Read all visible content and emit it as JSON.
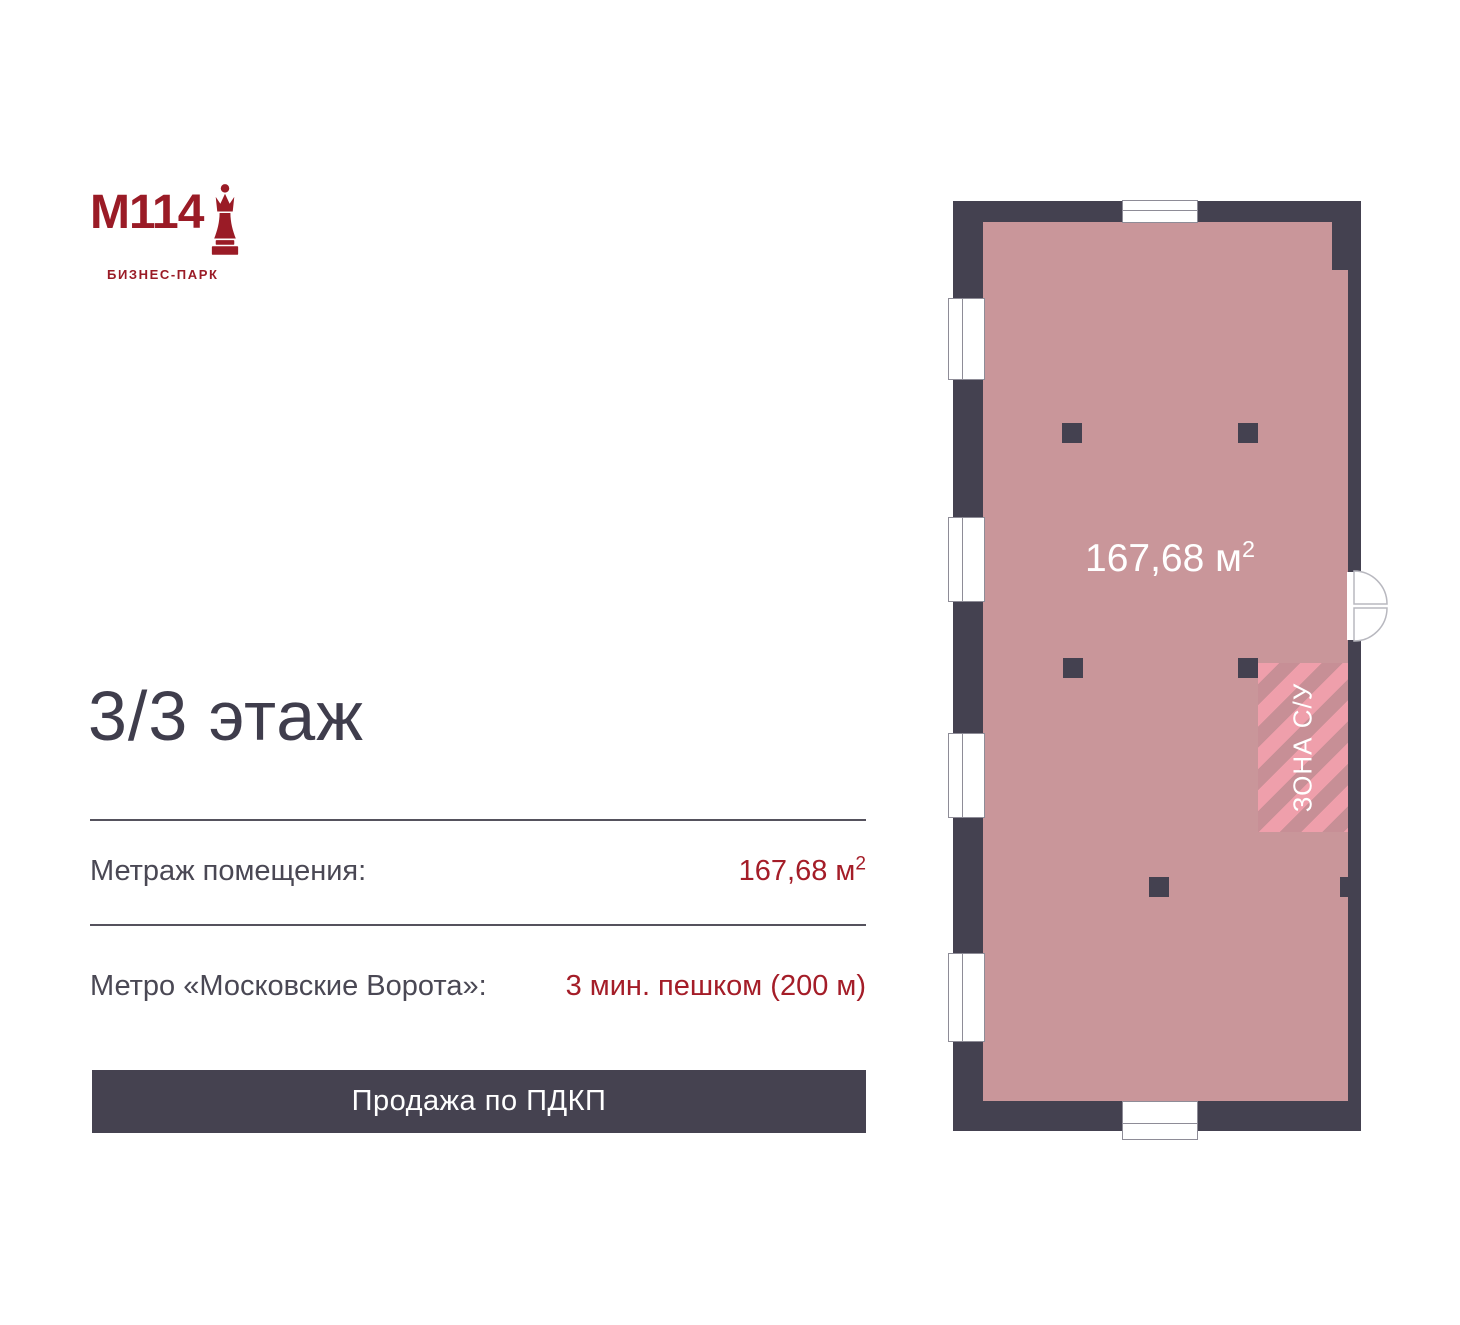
{
  "logo": {
    "brand": "M114",
    "subtitle": "БИЗНЕС-ПАРК",
    "icon": "chess-queen-icon"
  },
  "heading": "3/3 этаж",
  "details": [
    {
      "label": "Метраж помещения:",
      "value": "167,68 м",
      "sup": "2"
    },
    {
      "label": "Метро «Московские Ворота»:",
      "value": "3 мин. пешком (200 м)"
    }
  ],
  "banner": "Продажа по ПДКП",
  "plan": {
    "area_value": "167,68 м",
    "area_sup": "2",
    "zone_label": "ЗОНА С/У"
  },
  "colors": {
    "wall": "#444150",
    "room_fill": "#C9969A",
    "hatch_light": "#EF9FAB",
    "hatch_dark": "#C78F96",
    "accent_red": "#A41D28",
    "logo_red": "#9A1B26",
    "banner_bg": "#454250",
    "heading_text": "#3F3D4C",
    "label_text": "#4A4854"
  }
}
